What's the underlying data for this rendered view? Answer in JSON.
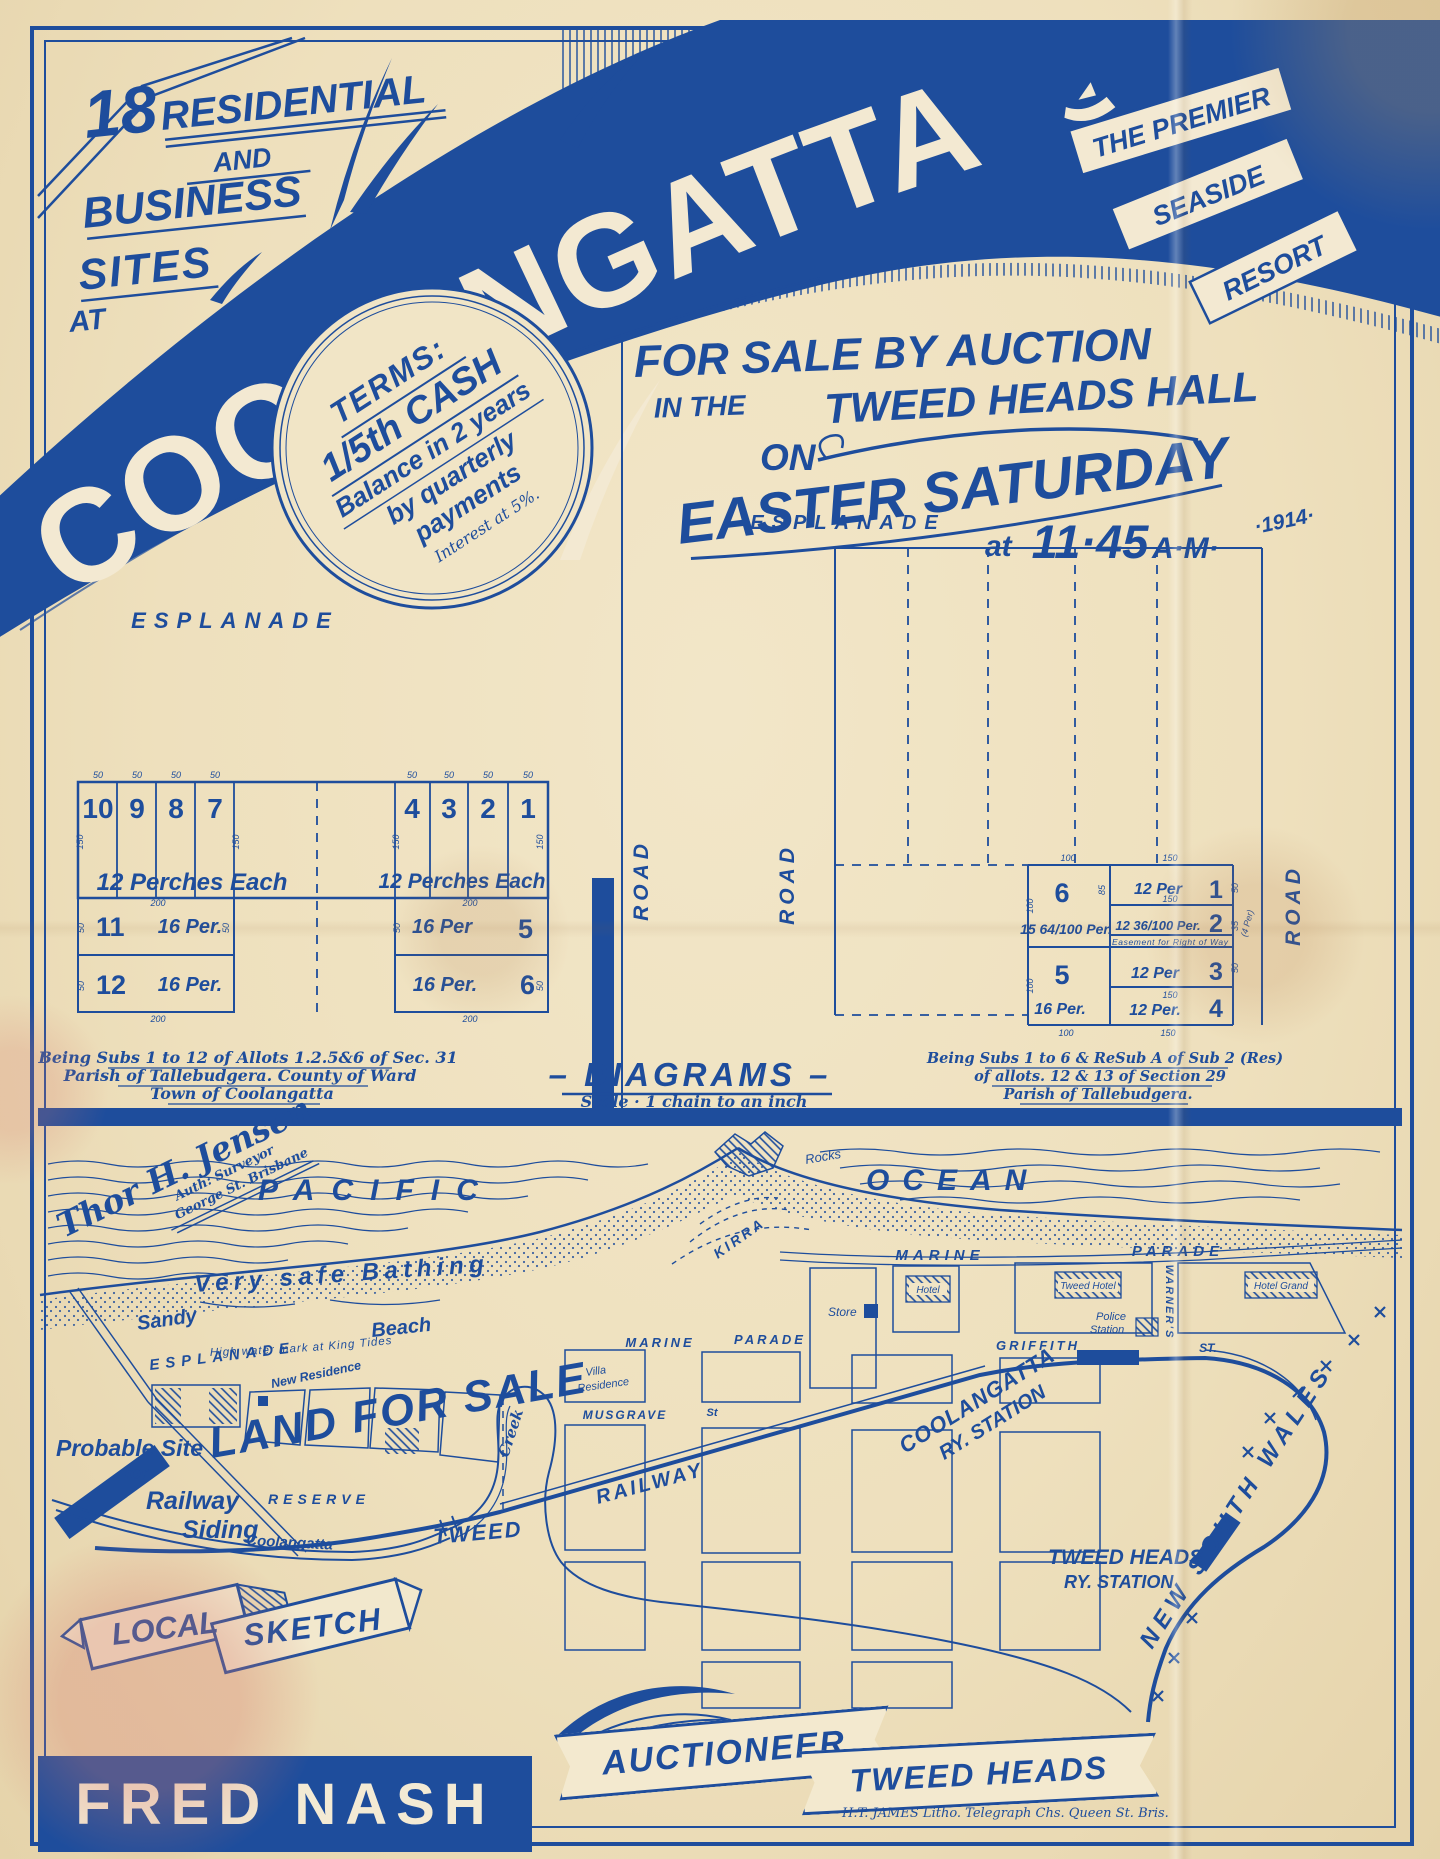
{
  "palette": {
    "ink": "#1e4d9c",
    "paper": "#efe2c2"
  },
  "header": {
    "sites": [
      "18",
      "RESIDENTIAL",
      "AND",
      "BUSINESS",
      "SITES",
      "AT"
    ],
    "town": "COOLANGATTA",
    "ribbons": [
      "THE PREMIER",
      "SEASIDE",
      "RESORT"
    ],
    "terms": {
      "line1": "TERMS:",
      "line2": "1/5th CASH",
      "line3": "Balance in 2 years",
      "line4": "by quarterly",
      "line5": "payments",
      "line6": "Interest at 5%."
    },
    "auction": {
      "line1": "FOR SALE BY AUCTION",
      "line2a": "IN THE",
      "line2b": "TWEED HEADS HALL",
      "line3": "ON",
      "line4": "EASTER SATURDAY",
      "at": "at",
      "time": "11·45",
      "ampm": "A·M·",
      "year": "·1914·"
    }
  },
  "diagrams": {
    "road_label": "ROAD",
    "title": "– DIAGRAMS –",
    "scale": "Scale · 1 chain to an inch",
    "dims": {
      "d50": "50",
      "d100": "100",
      "d150": "150",
      "d200": "200",
      "d85": "85",
      "d35": "35"
    },
    "left": {
      "street": "ESPLANADE",
      "row1": {
        "lots": [
          "10",
          "9",
          "8",
          "7",
          "4",
          "3",
          "2",
          "1"
        ],
        "area_left": "12 Perches Each",
        "area_right": "12 Perches Each"
      },
      "row2": {
        "lot11": "11",
        "lot11_area": "16 Per.",
        "lot12": "12",
        "lot12_area": "16 Per.",
        "lot5": "5",
        "lot5_area": "16 Per",
        "lot6": "6",
        "lot6_area": "16 Per."
      },
      "caption": [
        "Being Subs 1 to 12 of Allots 1.2.5&6 of Sec. 31",
        "Parish of Tallebudgera. County of Ward",
        "Town of Coolangatta"
      ]
    },
    "right": {
      "street": "ESPLANADE",
      "lot6": "6",
      "lot6_area": "15 64/100 Per.",
      "lot1": "1",
      "lot1_area": "12 Per",
      "lot2": "2",
      "lot2_area": "12 36/100 Per.",
      "easement": "Easement for Right of Way",
      "easement_note": "(4 Per)",
      "lot5": "5",
      "lot5_area": "16 Per.",
      "lot3": "3",
      "lot3_area": "12 Per",
      "lot4": "4",
      "lot4_area": "12 Per.",
      "caption": [
        "Being Subs 1 to 6 & ReSub A of Sub 2 (Res)",
        "of allots. 12 & 13 of Section 29",
        "Parish of Tallebudgera."
      ]
    }
  },
  "map": {
    "signature": {
      "name": "Thor H. Jensen",
      "title": "Auth: Surveyor",
      "addr": "George St. Brisbane"
    },
    "pacific": "PACIFIC",
    "ocean": "OCEAN",
    "rocks": "Rocks",
    "kirra": "KIRRA",
    "bathing": "Very safe Bathing",
    "sandy": "Sandy",
    "beach": "Beach",
    "hwm": "High water mark at King Tides",
    "esplanade": "ESPLANADE",
    "new_residence": "New Residence",
    "land_for_sale": "LAND FOR SALE",
    "probable1": "Probable Site",
    "probable2": "for",
    "probable3": "Railway",
    "probable4": "Siding",
    "reserve": "RESERVE",
    "creek": "Creek",
    "coolangatta_creek": "Coolangatta",
    "tweed_river": "TWEED",
    "railway": "RAILWAY",
    "marine1": "MARINE",
    "parade1": "PARADE",
    "marine2": "MARINE",
    "parade2": "PARADE",
    "griffith": "GRIFFITH",
    "griffith_st": "ST.",
    "musgrave": "MUSGRAVE",
    "musgrave_st": "St",
    "villa1": "Villa",
    "villa2": "Residence",
    "store": "Store",
    "hotel": "Hotel",
    "tweed_hotel": "Tweed Hotel",
    "police1": "Police",
    "police2": "Station",
    "warners": "WARNER'S",
    "hotel_grand": "Hotel Grand",
    "cool_station1": "COOLANGATTA",
    "cool_station2": "RY. STATION",
    "nsw": "NEW SOUTH WALES",
    "th_station1": "TWEED HEADS",
    "th_station2": "RY. STATION",
    "sketch1": "LOCAL",
    "sketch2": "SKETCH"
  },
  "footer": {
    "auctioneer_name": "FRED NASH",
    "auctioneer": "AUCTIONEER",
    "place": "TWEED HEADS",
    "litho": "H.T. JAMES Litho. Telegraph Chs. Queen St. Bris."
  }
}
